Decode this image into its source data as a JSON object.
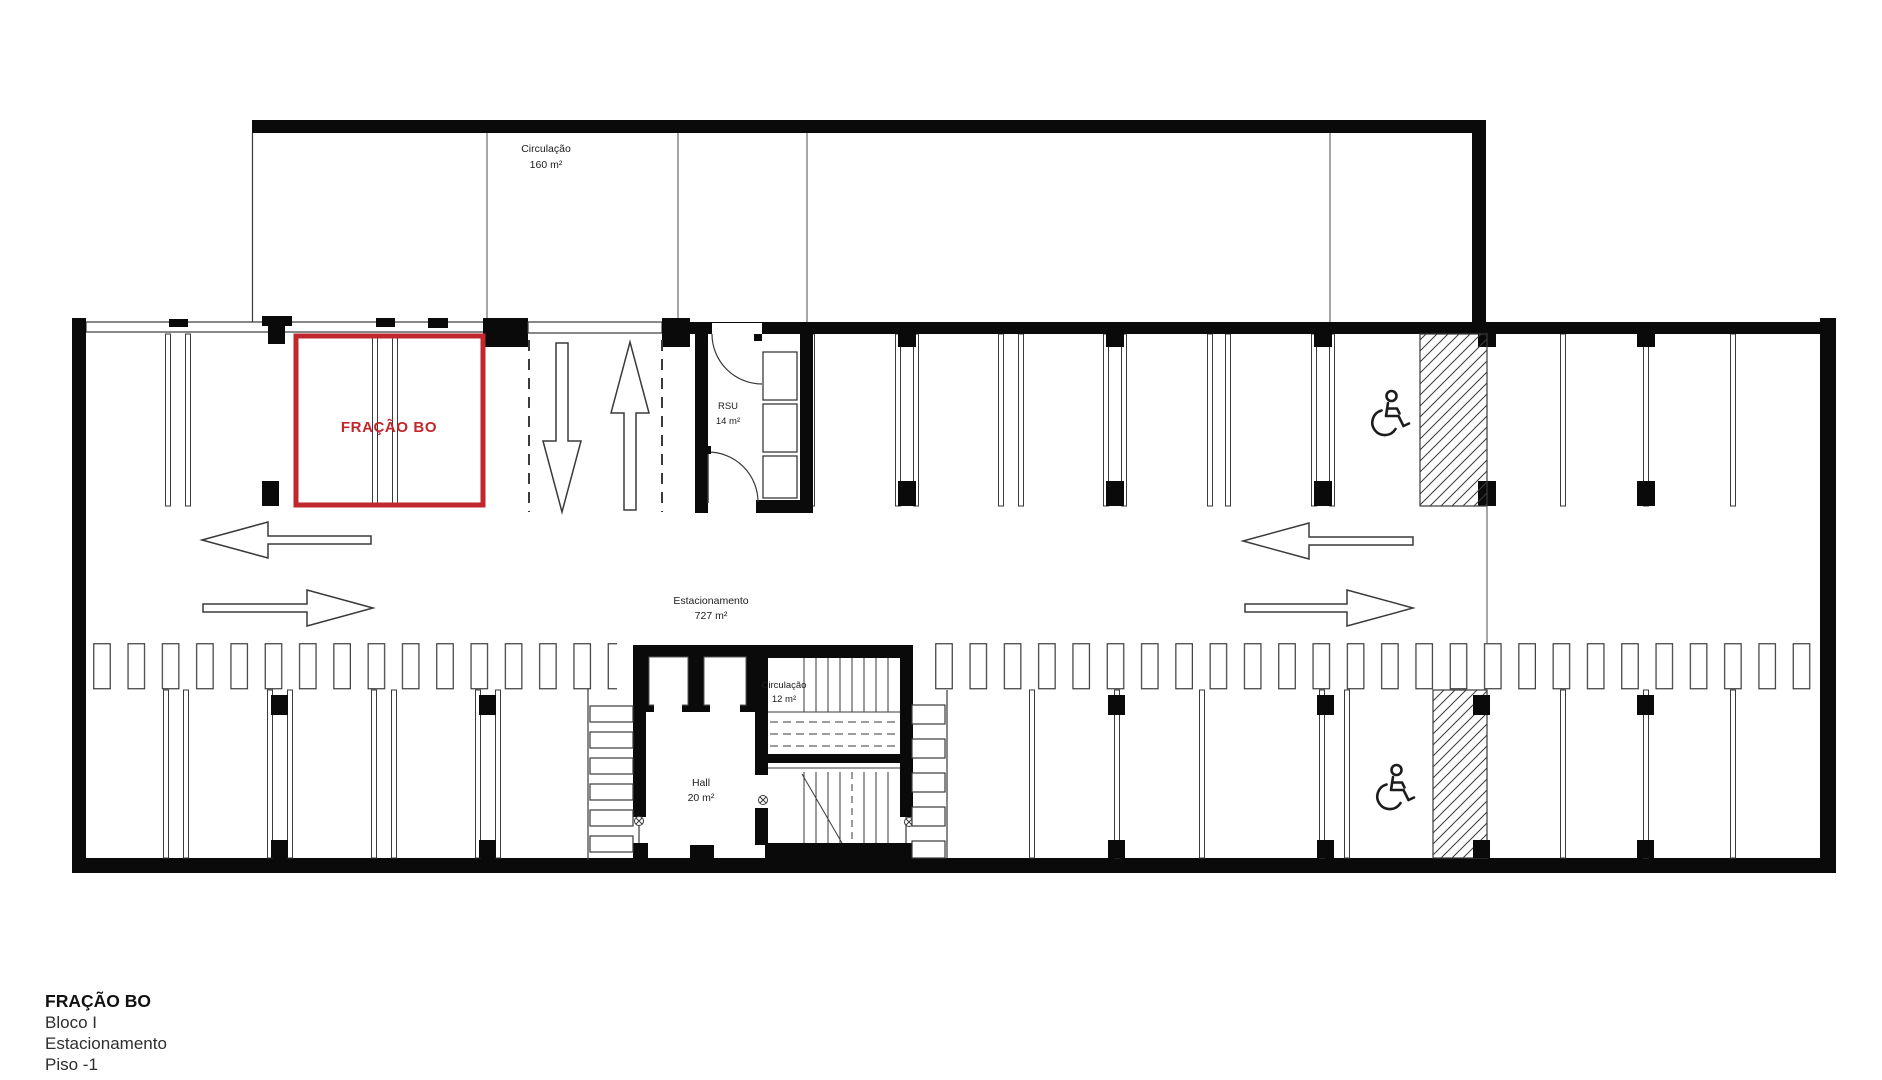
{
  "colors": {
    "wall": "#0a0a0a",
    "line": "#3a3a3a",
    "highlight_red": "#c2272d"
  },
  "rooms": {
    "upper_circulation": {
      "name": "Circulação",
      "area": "160 m²"
    },
    "parking": {
      "name": "Estacionamento",
      "area": "727 m²"
    },
    "rsu": {
      "name": "RSU",
      "area": "14 m²"
    },
    "stair_circulation": {
      "name": "Circulação",
      "area": "12 m²"
    },
    "hall": {
      "name": "Hall",
      "area": "20 m²"
    }
  },
  "highlight": {
    "label": "FRAÇÃO BO"
  },
  "icons": {
    "accessible_parking": "wheelchair-symbol"
  },
  "title_block": {
    "fraction": "FRAÇÃO BO",
    "block": "Bloco I",
    "usage": "Estacionamento",
    "floor": "Piso -1"
  }
}
